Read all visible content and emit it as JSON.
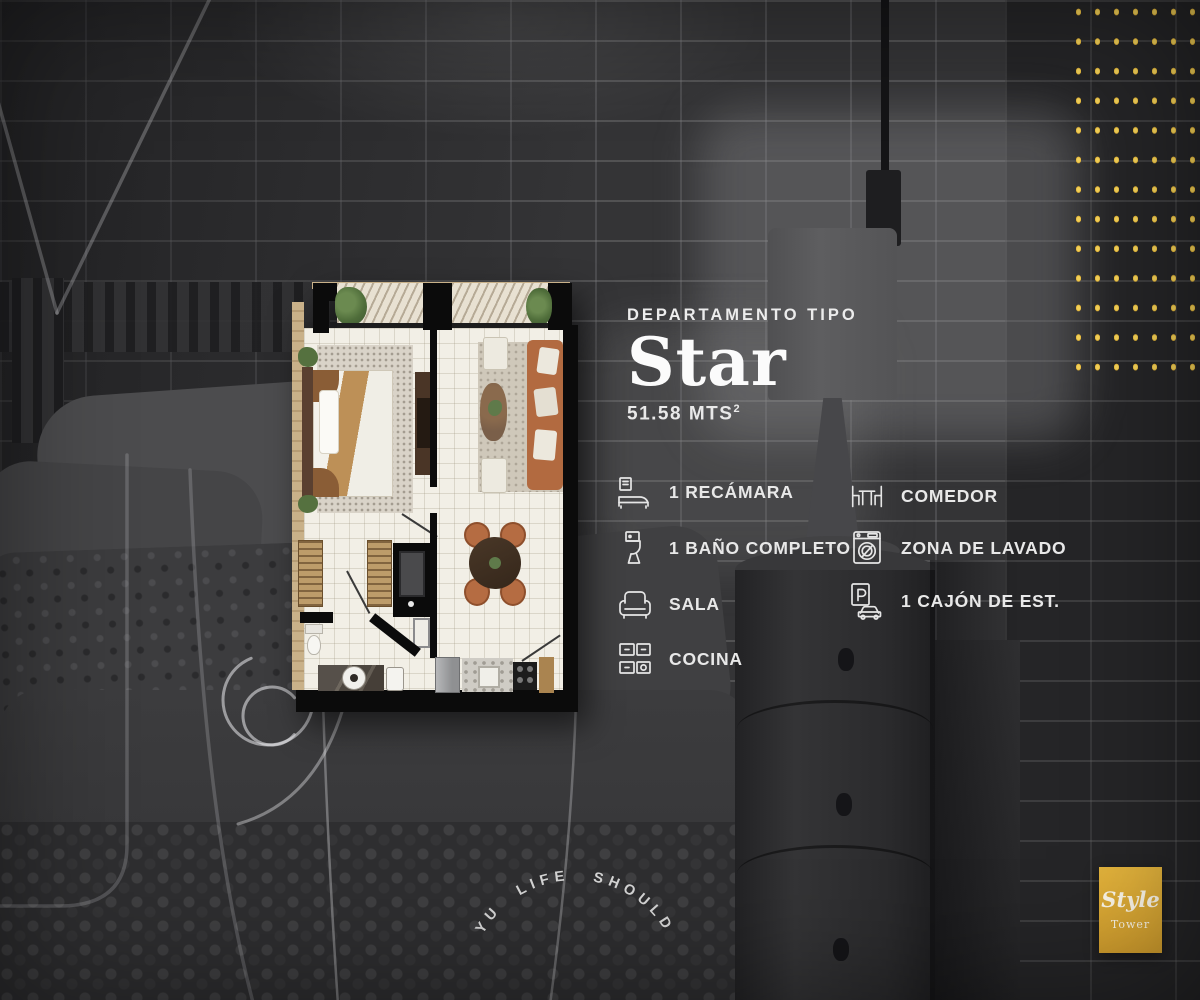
{
  "plan_card": {
    "type_label": "DEPARTAMENTO TIPO",
    "name": "Star",
    "area": "51.58 MTS",
    "area_sup": "2",
    "features_left": [
      {
        "icon": "bed-icon",
        "label": "1 RECÁMARA"
      },
      {
        "icon": "toilet-icon",
        "label": "1 BAÑO COMPLETO"
      },
      {
        "icon": "sofa-icon",
        "label": "SALA"
      },
      {
        "icon": "kitchen-icon",
        "label": "COCINA"
      }
    ],
    "features_right": [
      {
        "icon": "dining-icon",
        "label": "COMEDOR"
      },
      {
        "icon": "laundry-icon",
        "label": "ZONA DE LAVADO"
      },
      {
        "icon": "parking-icon",
        "label": "1 CAJÓN DE EST."
      }
    ]
  },
  "branding": {
    "logo_title": "Style",
    "logo_subtitle": "Tower",
    "curved_text": "YU LIFE SHOULD",
    "accent_yellow": "#e8bd3f"
  }
}
